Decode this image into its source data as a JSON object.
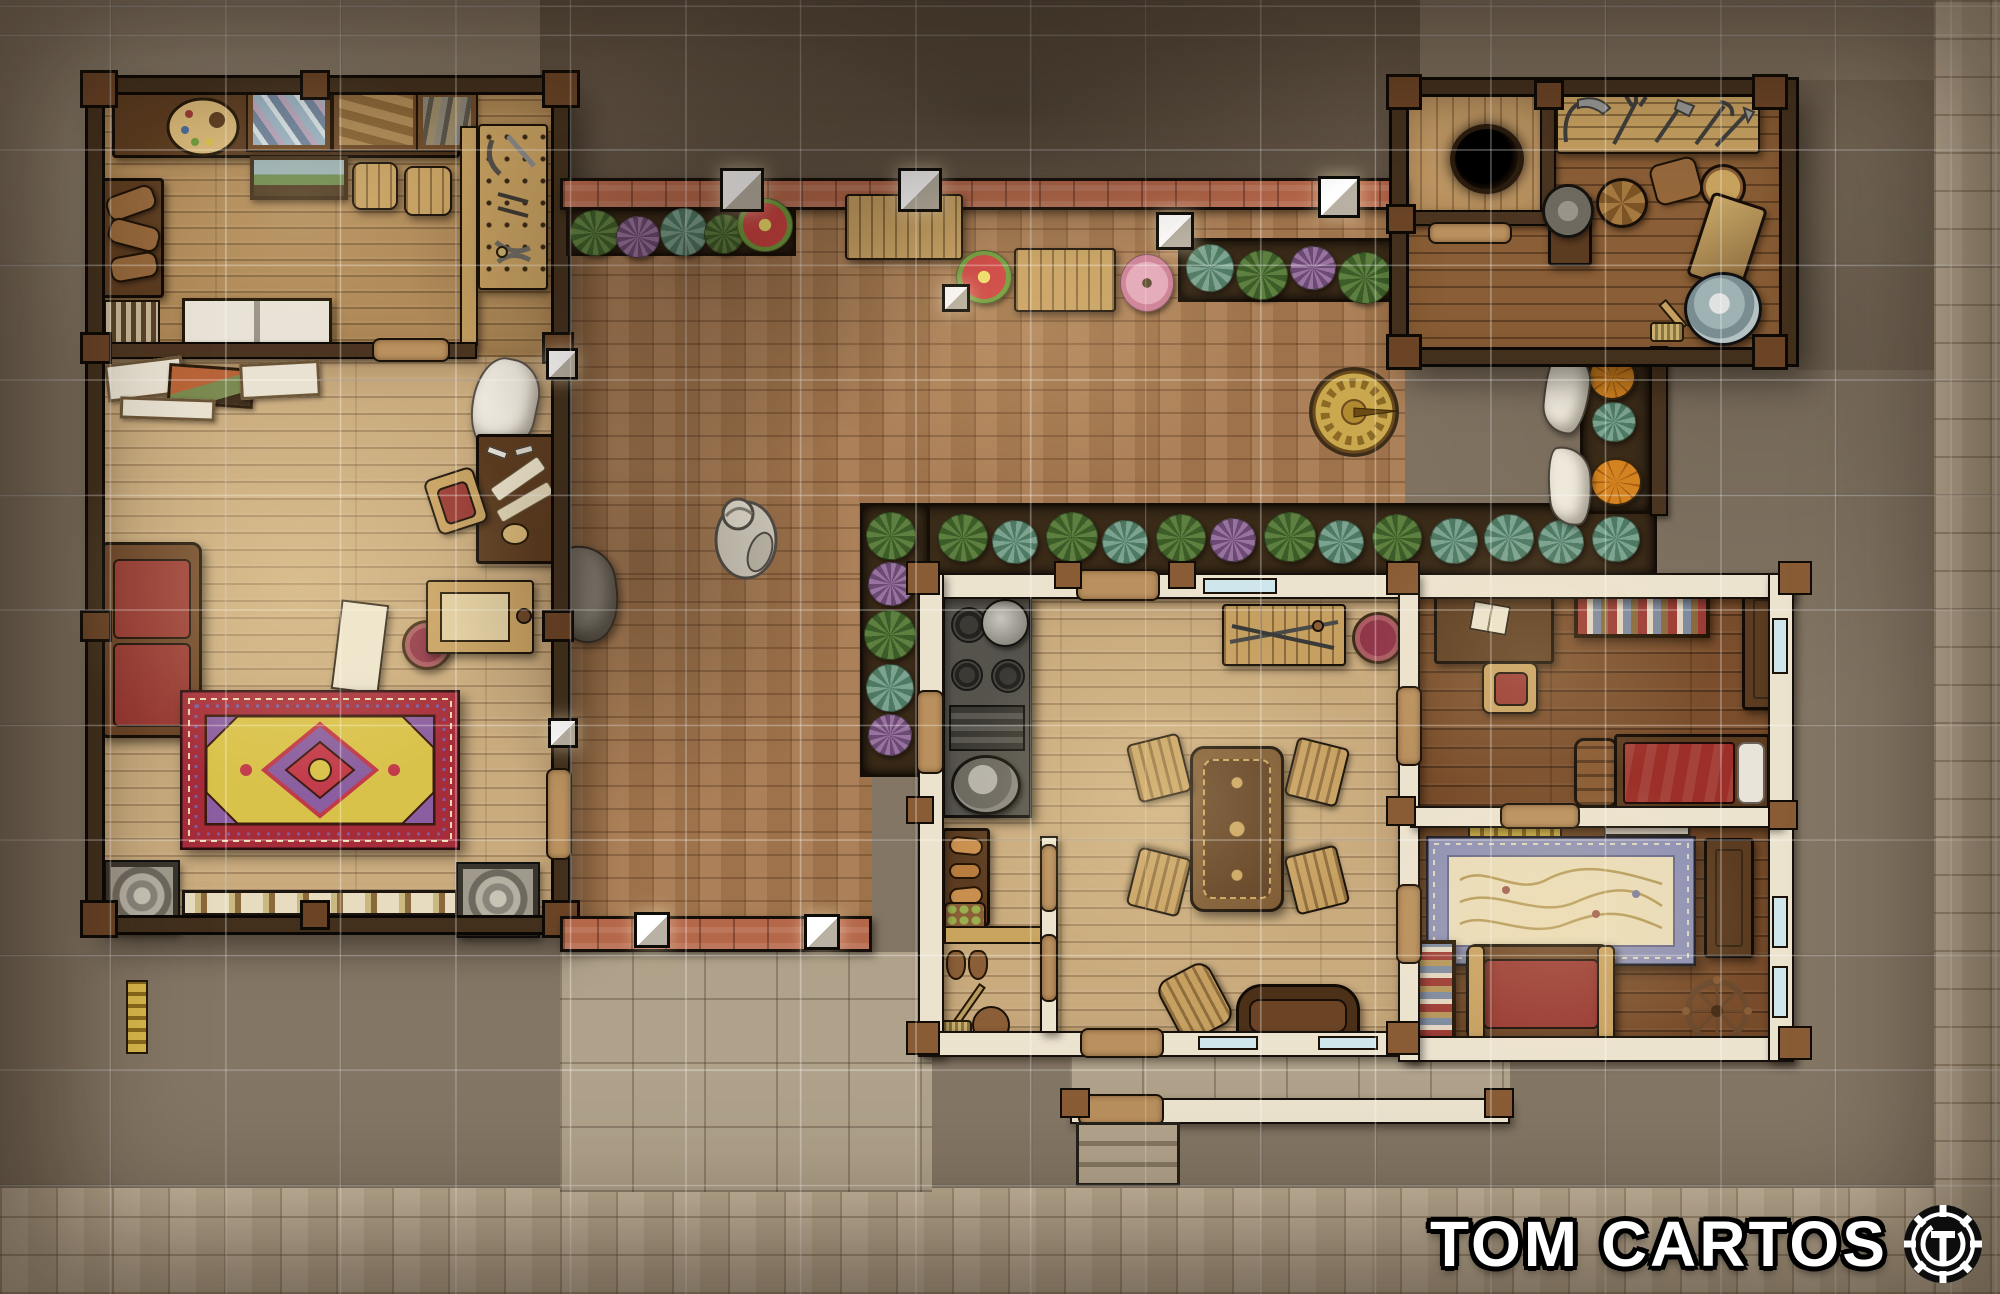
{
  "watermark": {
    "title": "TOM CARTOS",
    "logo": "TC-gear-monogram"
  },
  "palette": {
    "stone_outer": "#847664",
    "cobble_light": "#c6b59a",
    "courtyard_brick": "#a87a50",
    "garden_wall_brick": "#b5674a",
    "wood_floor_light": "#c9ab7e",
    "wood_floor_warm": "#b08a58",
    "wood_floor_dark": "#7a4e2c",
    "timber_wall": "#42301d",
    "plaster_wall": "#ece3cf",
    "door_wood": "#b9905e",
    "window_glass": "#cfe7ec",
    "rug_red": "#a62c3a",
    "rug_gold": "#d9c24a",
    "rug_blue": "#8e91b5",
    "sofa_red": "#983832",
    "plant_green": "#5d8040",
    "plant_teal": "#7ba390",
    "plant_purple": "#99729f",
    "pumpkin_orange": "#d3831f",
    "grid_line": "rgba(255,255,255,0.35)"
  },
  "scene": {
    "type": "top-down fantasy battlemap",
    "grid": {
      "cell_px": 115,
      "visible": true
    },
    "areas": [
      "artist-workshop",
      "great-hall",
      "walled-courtyard",
      "garden-shed",
      "well-alcove",
      "kitchen",
      "dining-room",
      "pantry",
      "study-bedroom",
      "sitting-room",
      "porch",
      "stone-street"
    ],
    "props": [
      "paint-palette",
      "supply-crates",
      "workbench",
      "stools",
      "leaning-painting",
      "canvas-stack",
      "white-cabinet",
      "leather-bundles",
      "chisel-rack",
      "red-sofa",
      "cloth-table",
      "round-stool",
      "fur-hide",
      "art-desk",
      "easel",
      "grey-sack",
      "ornate-red-rug",
      "stone-relief-plaques",
      "carved-molding",
      "garden-benches",
      "flower-planters",
      "red-flower",
      "pink-potted-flower",
      "sundial",
      "garden-statue",
      "vegetable-beds",
      "pumpkins",
      "cabbages",
      "hanging-linens",
      "garden-tool-rack",
      "grinding-wheel",
      "barrel",
      "storage-sack",
      "wheelbarrow",
      "metal-tub",
      "scrub-brush",
      "well-hole",
      "iron-stove",
      "kettle",
      "cooking-pot",
      "bread-shelf",
      "fruit-basket",
      "boots",
      "broom",
      "bucket",
      "dining-table",
      "dining-chairs",
      "weapon-bench",
      "maroon-stools",
      "rocking-chair",
      "settee",
      "study-desk",
      "open-book",
      "desk-chair",
      "bookshelves",
      "cabinet",
      "bed-red-blanket",
      "blue-floral-rug",
      "gold-shelf",
      "white-shelf",
      "storage-chest",
      "spinning-wheel",
      "wall-lanterns",
      "porch-steps"
    ]
  }
}
